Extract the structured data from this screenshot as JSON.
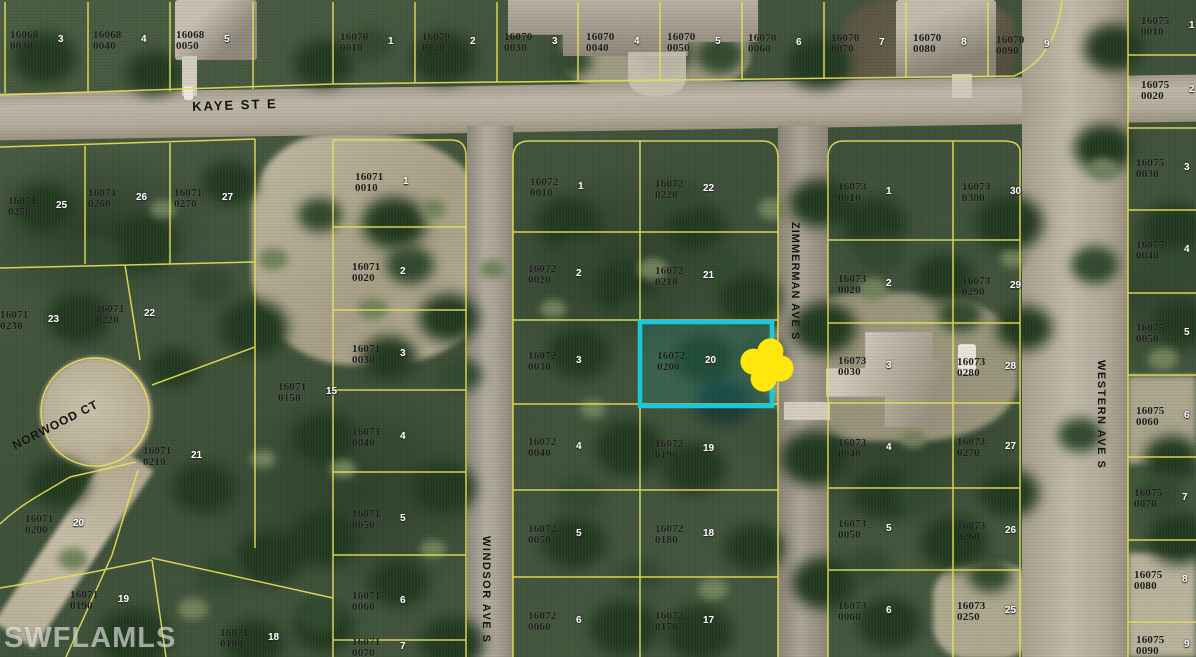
{
  "map": {
    "watermark": "SWFLAMLS",
    "colors": {
      "parcel_line": "#e7df55",
      "highlight_outline": "#17c9da",
      "marker": "#ffe70c",
      "label_text": "#1c1c1c",
      "lot_chip_text": "#ffffff"
    },
    "highlight": {
      "parcel": "16072 0200",
      "color": "#17c9da"
    },
    "marker": {
      "shape": "clover",
      "color": "#ffe70c"
    },
    "streets": [
      {
        "name": "KAYE ST E",
        "x": 192,
        "y": 99,
        "rot": -2,
        "size": 13,
        "spacing": 2
      },
      {
        "name": "NORWOOD CT",
        "x": 10,
        "y": 440,
        "rot": -27,
        "size": 12,
        "spacing": 1
      },
      {
        "name": "WINDSOR AVE S",
        "x": 492,
        "y": 536,
        "rot": 90,
        "size": 11,
        "spacing": 1.5
      },
      {
        "name": "ZIMMERMAN AVE S",
        "x": 801,
        "y": 222,
        "rot": 90,
        "size": 11,
        "spacing": 1
      },
      {
        "name": "WESTERN AVE S",
        "x": 1107,
        "y": 360,
        "rot": 90,
        "size": 11,
        "spacing": 1.5
      }
    ],
    "parcels": [
      {
        "apn": "16068",
        "suffix": "0030",
        "lot": "3",
        "x": 10,
        "y": 30
      },
      {
        "apn": "16068",
        "suffix": "0040",
        "lot": "4",
        "x": 93,
        "y": 30
      },
      {
        "apn": "16068",
        "suffix": "0050",
        "lot": "5",
        "x": 176,
        "y": 30
      },
      {
        "apn": "16070",
        "suffix": "0010",
        "lot": "1",
        "x": 340,
        "y": 32
      },
      {
        "apn": "16070",
        "suffix": "0020",
        "lot": "2",
        "x": 422,
        "y": 32
      },
      {
        "apn": "16070",
        "suffix": "0030",
        "lot": "3",
        "x": 504,
        "y": 32
      },
      {
        "apn": "16070",
        "suffix": "0040",
        "lot": "4",
        "x": 586,
        "y": 32
      },
      {
        "apn": "16070",
        "suffix": "0050",
        "lot": "5",
        "x": 667,
        "y": 32
      },
      {
        "apn": "16070",
        "suffix": "0060",
        "lot": "6",
        "x": 748,
        "y": 33
      },
      {
        "apn": "16070",
        "suffix": "0070",
        "lot": "7",
        "x": 831,
        "y": 33
      },
      {
        "apn": "16070",
        "suffix": "0080",
        "lot": "8",
        "x": 913,
        "y": 33
      },
      {
        "apn": "16070",
        "suffix": "0090",
        "lot": "9",
        "x": 996,
        "y": 35
      },
      {
        "apn": "16075",
        "suffix": "0010",
        "lot": "1",
        "x": 1141,
        "y": 16
      },
      {
        "apn": "16075",
        "suffix": "0020",
        "lot": "2",
        "x": 1141,
        "y": 80
      },
      {
        "apn": "16075",
        "suffix": "0030",
        "lot": "3",
        "x": 1136,
        "y": 158
      },
      {
        "apn": "16075",
        "suffix": "0040",
        "lot": "4",
        "x": 1136,
        "y": 240
      },
      {
        "apn": "16075",
        "suffix": "0050",
        "lot": "5",
        "x": 1136,
        "y": 323
      },
      {
        "apn": "16075",
        "suffix": "0060",
        "lot": "6",
        "x": 1136,
        "y": 406
      },
      {
        "apn": "16075",
        "suffix": "0070",
        "lot": "7",
        "x": 1134,
        "y": 488
      },
      {
        "apn": "16075",
        "suffix": "0080",
        "lot": "8",
        "x": 1134,
        "y": 570
      },
      {
        "apn": "16075",
        "suffix": "0090",
        "lot": "9",
        "x": 1136,
        "y": 635
      },
      {
        "apn": "16071",
        "suffix": "0250",
        "lot": "25",
        "x": 8,
        "y": 196
      },
      {
        "apn": "16071",
        "suffix": "0260",
        "lot": "26",
        "x": 88,
        "y": 188
      },
      {
        "apn": "16071",
        "suffix": "0270",
        "lot": "27",
        "x": 174,
        "y": 188
      },
      {
        "apn": "16071",
        "suffix": "0230",
        "lot": "23",
        "x": 0,
        "y": 310
      },
      {
        "apn": "16071",
        "suffix": "0220",
        "lot": "22",
        "x": 96,
        "y": 304
      },
      {
        "apn": "16071",
        "suffix": "0150",
        "lot": "15",
        "x": 278,
        "y": 382
      },
      {
        "apn": "16071",
        "suffix": "0210",
        "lot": "21",
        "x": 143,
        "y": 446
      },
      {
        "apn": "16071",
        "suffix": "0200",
        "lot": "20",
        "x": 25,
        "y": 514
      },
      {
        "apn": "16071",
        "suffix": "0190",
        "lot": "19",
        "x": 70,
        "y": 590
      },
      {
        "apn": "16071",
        "suffix": "0180",
        "lot": "18",
        "x": 220,
        "y": 628
      },
      {
        "apn": "16071",
        "suffix": "0010",
        "lot": "1",
        "x": 355,
        "y": 172
      },
      {
        "apn": "16071",
        "suffix": "0020",
        "lot": "2",
        "x": 352,
        "y": 262
      },
      {
        "apn": "16071",
        "suffix": "0030",
        "lot": "3",
        "x": 352,
        "y": 344
      },
      {
        "apn": "16071",
        "suffix": "0040",
        "lot": "4",
        "x": 352,
        "y": 427
      },
      {
        "apn": "16071",
        "suffix": "0050",
        "lot": "5",
        "x": 352,
        "y": 509
      },
      {
        "apn": "16071",
        "suffix": "0060",
        "lot": "6",
        "x": 352,
        "y": 591
      },
      {
        "apn": "16071",
        "suffix": "0070",
        "lot": "7",
        "x": 352,
        "y": 637
      },
      {
        "apn": "16072",
        "suffix": "0010",
        "lot": "1",
        "x": 530,
        "y": 177
      },
      {
        "apn": "16072",
        "suffix": "0020",
        "lot": "2",
        "x": 528,
        "y": 264
      },
      {
        "apn": "16072",
        "suffix": "0030",
        "lot": "3",
        "x": 528,
        "y": 351
      },
      {
        "apn": "16072",
        "suffix": "0040",
        "lot": "4",
        "x": 528,
        "y": 437
      },
      {
        "apn": "16072",
        "suffix": "0050",
        "lot": "5",
        "x": 528,
        "y": 524
      },
      {
        "apn": "16072",
        "suffix": "0060",
        "lot": "6",
        "x": 528,
        "y": 611
      },
      {
        "apn": "16072",
        "suffix": "0220",
        "lot": "22",
        "x": 655,
        "y": 179
      },
      {
        "apn": "16072",
        "suffix": "0210",
        "lot": "21",
        "x": 655,
        "y": 266
      },
      {
        "apn": "16072",
        "suffix": "0200",
        "lot": "20",
        "x": 657,
        "y": 351,
        "highlighted": true
      },
      {
        "apn": "16072",
        "suffix": "0190",
        "lot": "19",
        "x": 655,
        "y": 439
      },
      {
        "apn": "16072",
        "suffix": "0180",
        "lot": "18",
        "x": 655,
        "y": 524
      },
      {
        "apn": "16072",
        "suffix": "0170",
        "lot": "17",
        "x": 655,
        "y": 611
      },
      {
        "apn": "16073",
        "suffix": "0010",
        "lot": "1",
        "x": 838,
        "y": 182
      },
      {
        "apn": "16073",
        "suffix": "0300",
        "lot": "30",
        "x": 962,
        "y": 182
      },
      {
        "apn": "16073",
        "suffix": "0020",
        "lot": "2",
        "x": 838,
        "y": 274
      },
      {
        "apn": "16073",
        "suffix": "0290",
        "lot": "29",
        "x": 962,
        "y": 276
      },
      {
        "apn": "16073",
        "suffix": "0030",
        "lot": "3",
        "x": 838,
        "y": 356
      },
      {
        "apn": "16073",
        "suffix": "0280",
        "lot": "28",
        "x": 957,
        "y": 357
      },
      {
        "apn": "16073",
        "suffix": "0040",
        "lot": "4",
        "x": 838,
        "y": 438
      },
      {
        "apn": "16073",
        "suffix": "0270",
        "lot": "27",
        "x": 957,
        "y": 437
      },
      {
        "apn": "16073",
        "suffix": "0050",
        "lot": "5",
        "x": 838,
        "y": 519
      },
      {
        "apn": "16073",
        "suffix": "0260",
        "lot": "26",
        "x": 957,
        "y": 521
      },
      {
        "apn": "16073",
        "suffix": "0060",
        "lot": "6",
        "x": 838,
        "y": 601
      },
      {
        "apn": "16073",
        "suffix": "0250",
        "lot": "25",
        "x": 957,
        "y": 601
      }
    ]
  }
}
